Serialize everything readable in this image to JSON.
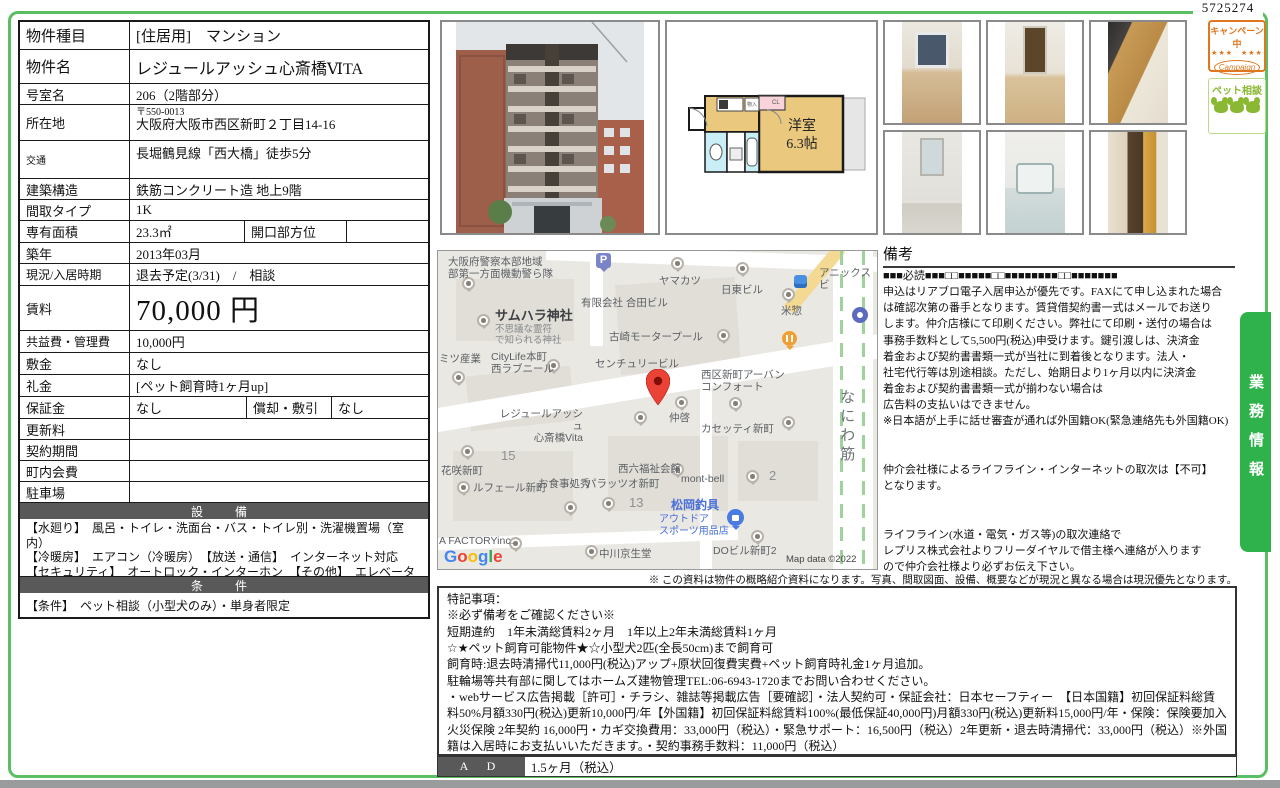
{
  "page": {
    "doc_number": "5725274",
    "side_tab": "業務情報",
    "bottom_note": "※ この資料は物件の概略紹介資料になります。写真、間取図面、設備、概要などが現況と異なる場合は現況優先となります。",
    "colors": {
      "frame_green": "#5abf63",
      "tab_green": "#2fb24c",
      "header_gray": "#595959",
      "map_pin_red": "#EA4335"
    }
  },
  "stamps": {
    "campaign_jp": "キャンペーン中",
    "campaign_en": "Campaign",
    "campaign_stars": "★★★　★★★",
    "pet": "ペット相談"
  },
  "table": {
    "type_label": "物件種目",
    "type_value": "[住居用]　マンション",
    "name_label": "物件名",
    "name_value": "レジュールアッシュ心斎橋ⅥTA",
    "room_label": "号室名",
    "room_value": "206（2階部分）",
    "address_label": "所在地",
    "address_zip": "〒550-0013",
    "address_value": "大阪府大阪市西区新町２丁目14-16",
    "access_label": "交通",
    "access_value": "長堀鶴見線「西大橋」徒歩5分",
    "structure_label": "建築構造",
    "structure_value": "鉄筋コンクリート造 地上9階",
    "layout_label": "間取タイプ",
    "layout_value": "1K",
    "area_label": "専有面積",
    "area_value": "23.3㎡",
    "facing_label": "開口部方位",
    "facing_value": "",
    "built_label": "築年",
    "built_value": "2013年03月",
    "status_label": "現況/入居時期",
    "status_value": "退去予定(3/31)　/　相談",
    "rent_label": "賃料",
    "rent_value": "70,000 円",
    "fee_label": "共益費・管理費",
    "fee_value": "10,000円",
    "deposit_label": "敷金",
    "deposit_value": "なし",
    "keymoney_label": "礼金",
    "keymoney_value": "[ペット飼育時1ヶ月up]",
    "guarantee_label": "保証金",
    "guarantee_value": "なし",
    "amort_label": "償却・敷引",
    "amort_value": "なし",
    "renewal_label": "更新料",
    "renewal_value": "",
    "contract_label": "契約期間",
    "contract_value": "",
    "townfee_label": "町内会費",
    "townfee_value": "",
    "parking_label": "駐車場",
    "parking_value": ""
  },
  "equipment": {
    "header": "設　備",
    "text": "【水廻り】　風呂・トイレ・洗面台・バス・トイレ別・洗濯機置場（室内）\n【冷暖房】　エアコン（冷暖房）　【放送・通信】　インターネット対応　【セキュリティ】　オートロック・インターホン　【その他】　エレベーター（1基）"
  },
  "condition": {
    "header": "条　件",
    "text": "【条件】　ペット相談（小型犬のみ）・単身者限定"
  },
  "floorplan": {
    "room": "洋室",
    "size": "6.3帖",
    "closet": "CL",
    "storage": "物入"
  },
  "remarks": {
    "title": "備考",
    "body": "■■■必読■■■□□■■■■■□□■■■■■■■■□□■■■■■■■\n申込はリアブロ電子入居申込が優先です。FAXにて申し込まれた場合\nは確認次第の番手となります。賃貸借契約書一式はメールでお送り\nします。仲介店様にて印刷ください。弊社にて印刷・送付の場合は\n事務手数料として5,500円(税込)申受けます。鍵引渡しは、決済金\n着金および契約書書類一式が当社に到着後となります。法人・\n社宅代行等は別途相談。ただし、始期日より1ヶ月以内に決済金\n着金および契約書書類一式が揃わない場合は\n広告料の支払いはできません。\n※日本語が上手に話せ審査が通れば外国籍OK(緊急連絡先も外国籍OK)\n\n\n仲介会社様によるライフライン・インターネットの取次は【不可】\nとなります。\n\n\nライフライン(水道・電気・ガス等)の取次連絡で\nレプリス株式会社よりフリーダイヤルで借主様へ連絡が入ります\nので仲介会社様より必ずお伝え下さい。"
  },
  "notes": {
    "body": "特記事項：\n※必ず備考をご確認ください※\n短期違約　1年未満総賃料2ヶ月　1年以上2年未満総賃料1ヶ月\n☆★ペット飼育可能物件★☆小型犬2匹(全長50cm)まで飼育可\n飼育時:退去時清掃代11,000円(税込)アップ+原状回復費実費+ペット飼育時礼金1ヶ月追加。\n駐輪場等共有部に関してはホームズ建物管理TEL:06-6943-1720までお問い合わせください。\n・webサービス広告掲載［許可］・チラシ、雑誌等掲載広告［要確認］・法人契約可・保証会社：日本セーフティー　【日本国籍】初回保証料総賃料50%月額330円(税込)更新10,000円/年【外国籍】初回保証料総賃料100%(最低保証40,000円)月額330円(税込)更新料15,000円/年・保険：保険要加入 火災保険 2年契約 16,000円・カギ交換費用：33,000円（税込）・緊急サポート：16,500円（税込）2年更新・退去時清掃代：33,000円（税込）※外国籍は入居時にお支払いいただきます。・契約事務手数料：11,000円（税込）\n■3月末退去予定■"
  },
  "ad": {
    "label": "A D",
    "value": "1.5ヶ月（税込）"
  },
  "map": {
    "attribution": "Map data ©2022",
    "google": [
      "G",
      "o",
      "o",
      "g",
      "l",
      "e"
    ],
    "parking_letter": "P",
    "labels": {
      "police": "大阪府警察本部地域\n部第一方面機動警ら隊",
      "yamakatsu": "ヤマカツ",
      "goda": "有限会社 合田ビル",
      "nitto": "日東ビル",
      "yoneso": "米惣",
      "anix": "アニックスビ",
      "samuhara": "サムハラ神社",
      "samuhara_sub": "不思議な霊符\nで知られる神社",
      "mitsu": "ミツ産業",
      "citylife": "CityLife本町\n西ラブニール",
      "kosaki": "古崎モータープール",
      "century": "センチュリービル",
      "naniwasuji": "なにわ筋",
      "urban": "西区新町アーバン\nコンフォート",
      "lejour": "レジュールアッシュ\n心斎橋Vita",
      "nakakei": "仲啓",
      "cassetti": "カセッティ新町",
      "hanasaki": "花咲新町",
      "block15": "15",
      "lefeir": "ルフェール新町",
      "oshokuji": "お食事処秀",
      "seiroku": "西六福祉会館",
      "palazzo": "パラッツオ新町",
      "block13": "13",
      "montbell": "mont-bell",
      "block2": "2",
      "matsuoka": "松岡釣具",
      "matsuoka_sub": "アウトドア\nスポーツ用品店",
      "dobill": "DOビル新町2",
      "nakagawa": "中川京生堂",
      "afactory": "A FACTORYinc."
    }
  },
  "photos": [
    "room-interior-window",
    "room-interior-door",
    "kitchen-counter",
    "washroom-vanity",
    "unit-bathroom",
    "kitchen-hall-column"
  ]
}
